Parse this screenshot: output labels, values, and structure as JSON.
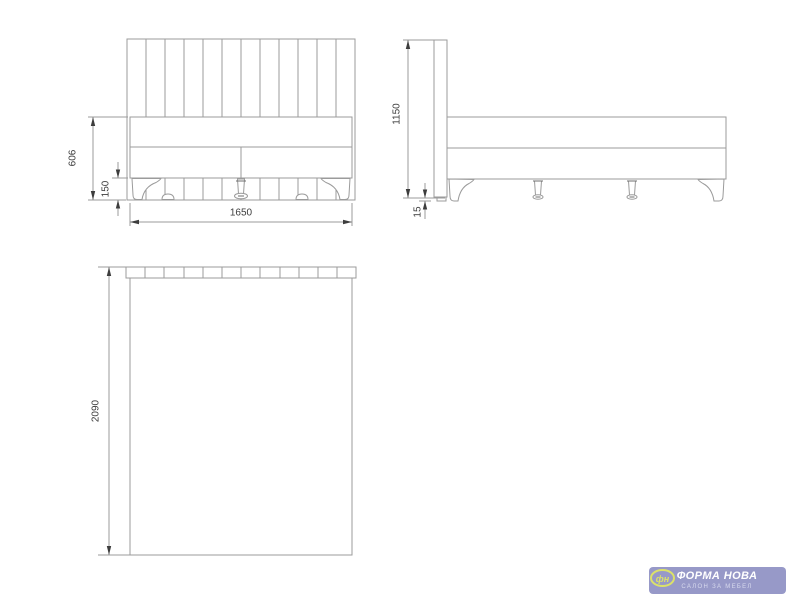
{
  "colors": {
    "background": "#ffffff",
    "line": "#9b9b9b",
    "dim": "#3d3d3d",
    "logo_bg": "#9799c8",
    "logo_accent": "#dce269",
    "logo_text": "#ffffff",
    "logo_subtext": "#d8daee"
  },
  "drawing": {
    "type": "furniture-dimension-drawing",
    "subject": "upholstered bed with slatted headboard, three orthographic views"
  },
  "views": {
    "front": {
      "label": "front view",
      "dims": {
        "body_height": "606",
        "leg_height": "150",
        "width": "1650"
      }
    },
    "side": {
      "label": "side view",
      "dims": {
        "height": "1150",
        "floor_gap": "15"
      }
    },
    "top": {
      "label": "top view",
      "dims": {
        "length": "2090"
      }
    }
  },
  "logo": {
    "title": "ФОРМА НОВА",
    "subtitle": "САЛОН ЗА МЕБЕЛ",
    "monogram": "фн"
  }
}
